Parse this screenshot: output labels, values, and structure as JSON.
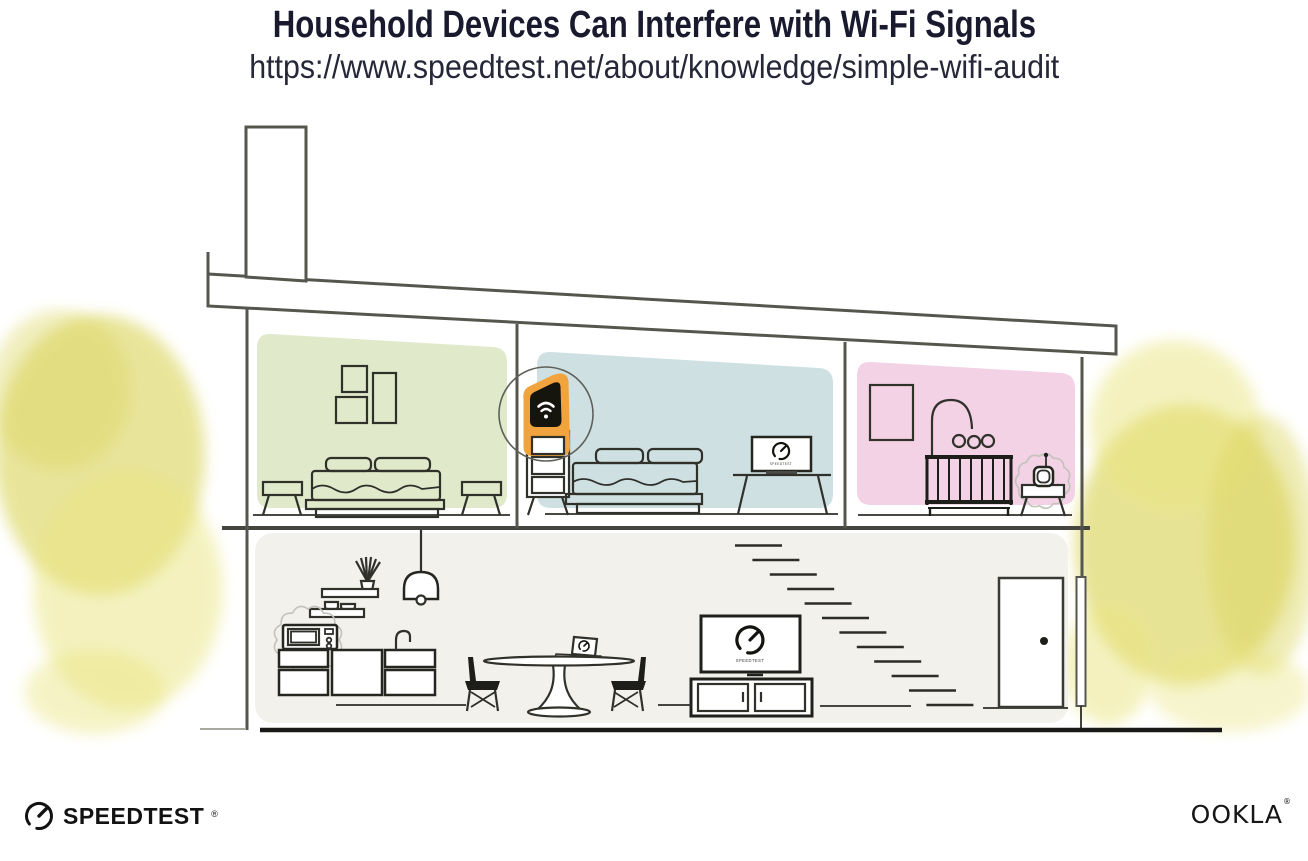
{
  "header": {
    "title": "Household Devices Can Interfere with Wi-Fi Signals",
    "url": "https://www.speedtest.net/about/knowledge/simple-wifi-audit"
  },
  "footer": {
    "speedtest_label": "SPEEDTEST",
    "speedtest_mark": "®",
    "ookla_label": "OOKLA",
    "ookla_mark": "®"
  },
  "illustration": {
    "tv_screen_brand": "SPEEDTEST",
    "bedroom_laptop_brand": "SPEEDTEST",
    "colors": {
      "bedroom_left_bg": "#e0e9ca",
      "bedroom_middle_bg": "#cfe0e2",
      "nursery_bg": "#f4d2e6",
      "downstairs_bg": "#f2f1ec",
      "router_highlight": "#f1a43e",
      "router_device": "#15150e",
      "foliage_main": "#dbd55d",
      "foliage_light": "#eae581"
    }
  }
}
